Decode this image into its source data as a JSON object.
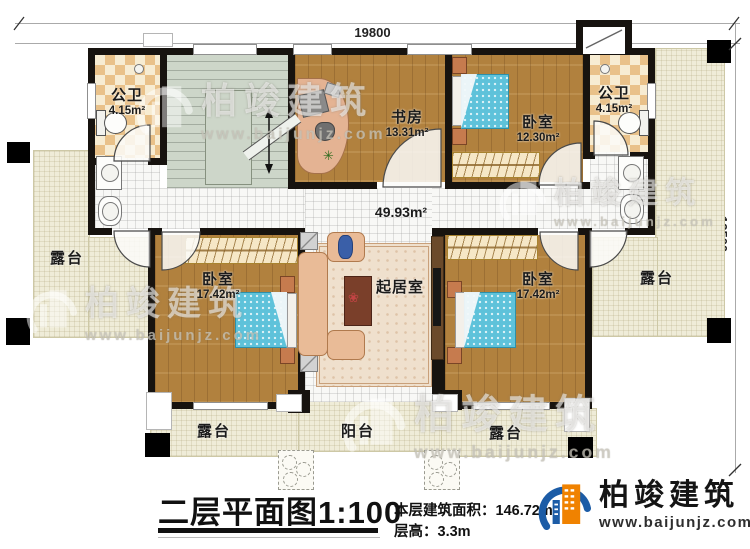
{
  "plan": {
    "dimensions": {
      "width_top": "19800",
      "height_right": "12500"
    },
    "rooms": {
      "bathroom_left": {
        "name": "公卫",
        "area": "4.15m²"
      },
      "bathroom_right": {
        "name": "公卫",
        "area": "4.15m²"
      },
      "study": {
        "name": "书房",
        "area": "13.31m²"
      },
      "bedroom_top": {
        "name": "卧室",
        "area": "12.30m²"
      },
      "bedroom_left": {
        "name": "卧室",
        "area": "17.42m²"
      },
      "bedroom_right": {
        "name": "卧室",
        "area": "17.42m²"
      },
      "living_room": {
        "name": "起居室"
      },
      "hall": {
        "area": "49.93m²"
      }
    },
    "outdoor": {
      "terrace_left": "露台",
      "terrace_right": "露台",
      "terrace_bottom_left": "露台",
      "terrace_bottom_right": "露台",
      "balcony": "阳台"
    }
  },
  "title_block": {
    "title": "二层平面图",
    "scale": "1:100",
    "floor_area": "本层建筑面积：146.72m²",
    "floor_height": "层高：3.3m"
  },
  "branding": {
    "logo_name": "柏竣建筑",
    "logo_url": "www.baijunjz.com",
    "watermark_text": "柏竣建筑",
    "watermark_url": "www.baijunjz.com",
    "logo_blue": "#1c5ca6",
    "logo_orange": "#f08200"
  }
}
